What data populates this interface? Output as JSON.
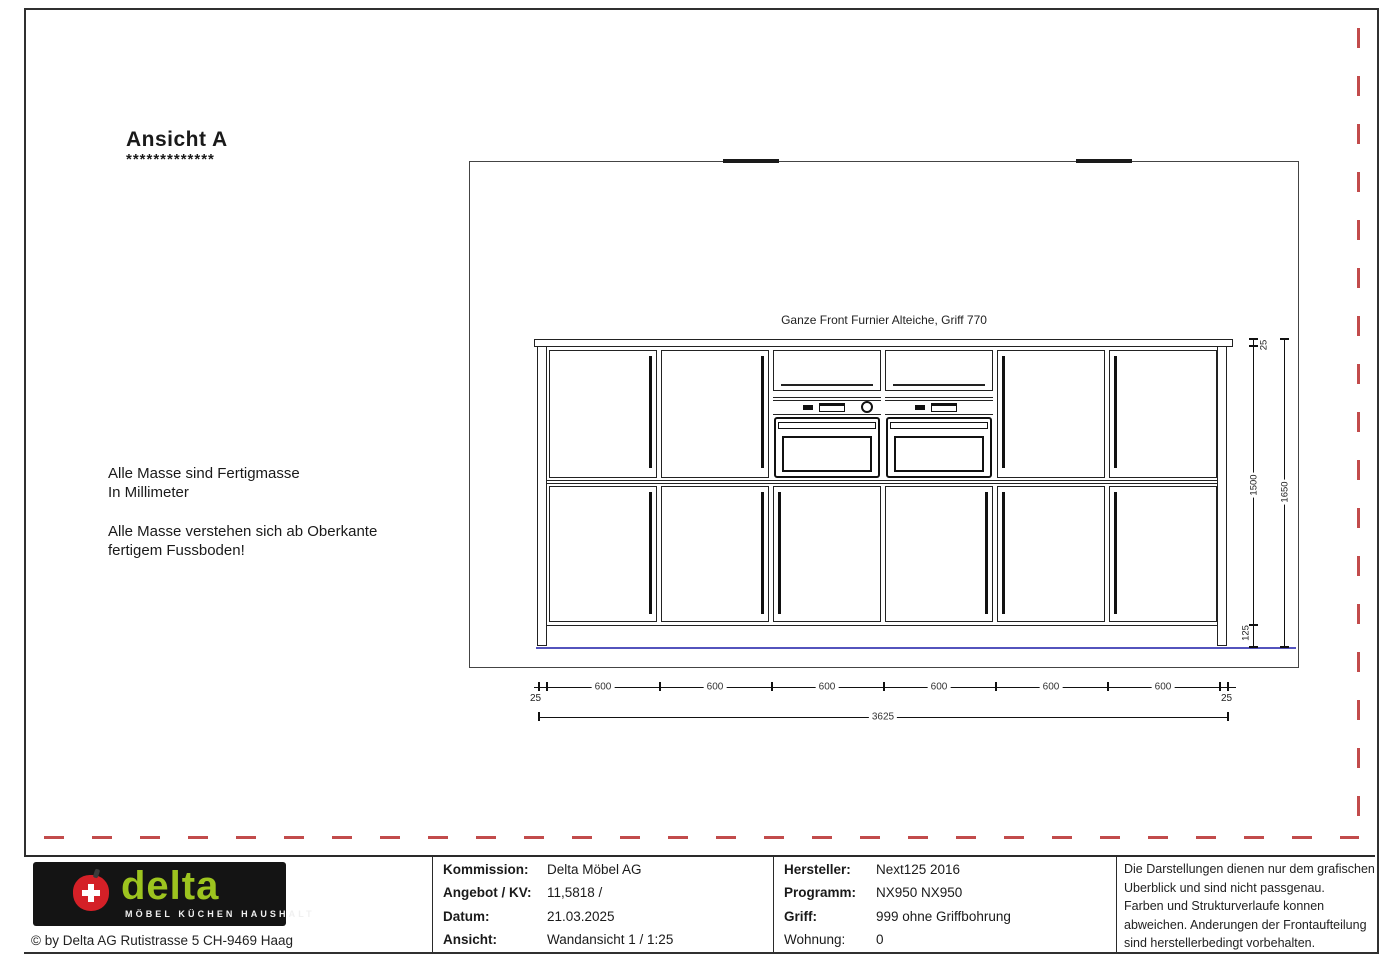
{
  "colors": {
    "red_dashed_border": "#c24b4b",
    "floor_line_blue": "#5353bd",
    "logo_green": "#9dc41f",
    "logo_apple_red": "#d42027",
    "logo_background": "#141414"
  },
  "header": {
    "title": "Ansicht A",
    "underline": "*************"
  },
  "notes": {
    "line1": "Alle Masse sind Fertigmasse",
    "line2": "In Millimeter",
    "line3": "Alle Masse verstehen sich ab Oberkante",
    "line4": "fertigem Fussboden!"
  },
  "drawing": {
    "front_label": "Ganze Front Furnier Alteiche, Griff 770",
    "dims": {
      "top_panel": "25",
      "door_height": "1500",
      "plinth": "125",
      "total_height": "1650",
      "segment": "600",
      "end_panel": "25",
      "total_width": "3625"
    }
  },
  "title_block": {
    "logo": {
      "brand": "delta",
      "tagline": "MÖBEL KÜCHEN HAUSHALT"
    },
    "copyright": "© by Delta AG Rutistrasse 5 CH-9469 Haag",
    "info_a": [
      {
        "label": "Kommission:",
        "value": "Delta Möbel AG"
      },
      {
        "label": "Angebot / KV:",
        "value": "11,5818 /"
      },
      {
        "label": "Datum:",
        "value": "21.03.2025"
      },
      {
        "label": "Ansicht:",
        "value": "Wandansicht 1 / 1:25"
      }
    ],
    "info_b": [
      {
        "label": "Hersteller:",
        "value": "Next125 2016"
      },
      {
        "label": "Programm:",
        "value": "NX950 NX950"
      },
      {
        "label": "Griff:",
        "value": "999 ohne Griffbohrung"
      },
      {
        "label": "Wohnung:",
        "value": "0"
      }
    ],
    "disclaimer": [
      "Die Darstellungen dienen nur dem grafischen",
      "Uberblick und sind nicht passgenau.",
      "Farben und Strukturverlaufe konnen",
      "abweichen. Anderungen der Frontaufteilung",
      "sind herstellerbedingt vorbehalten."
    ]
  }
}
